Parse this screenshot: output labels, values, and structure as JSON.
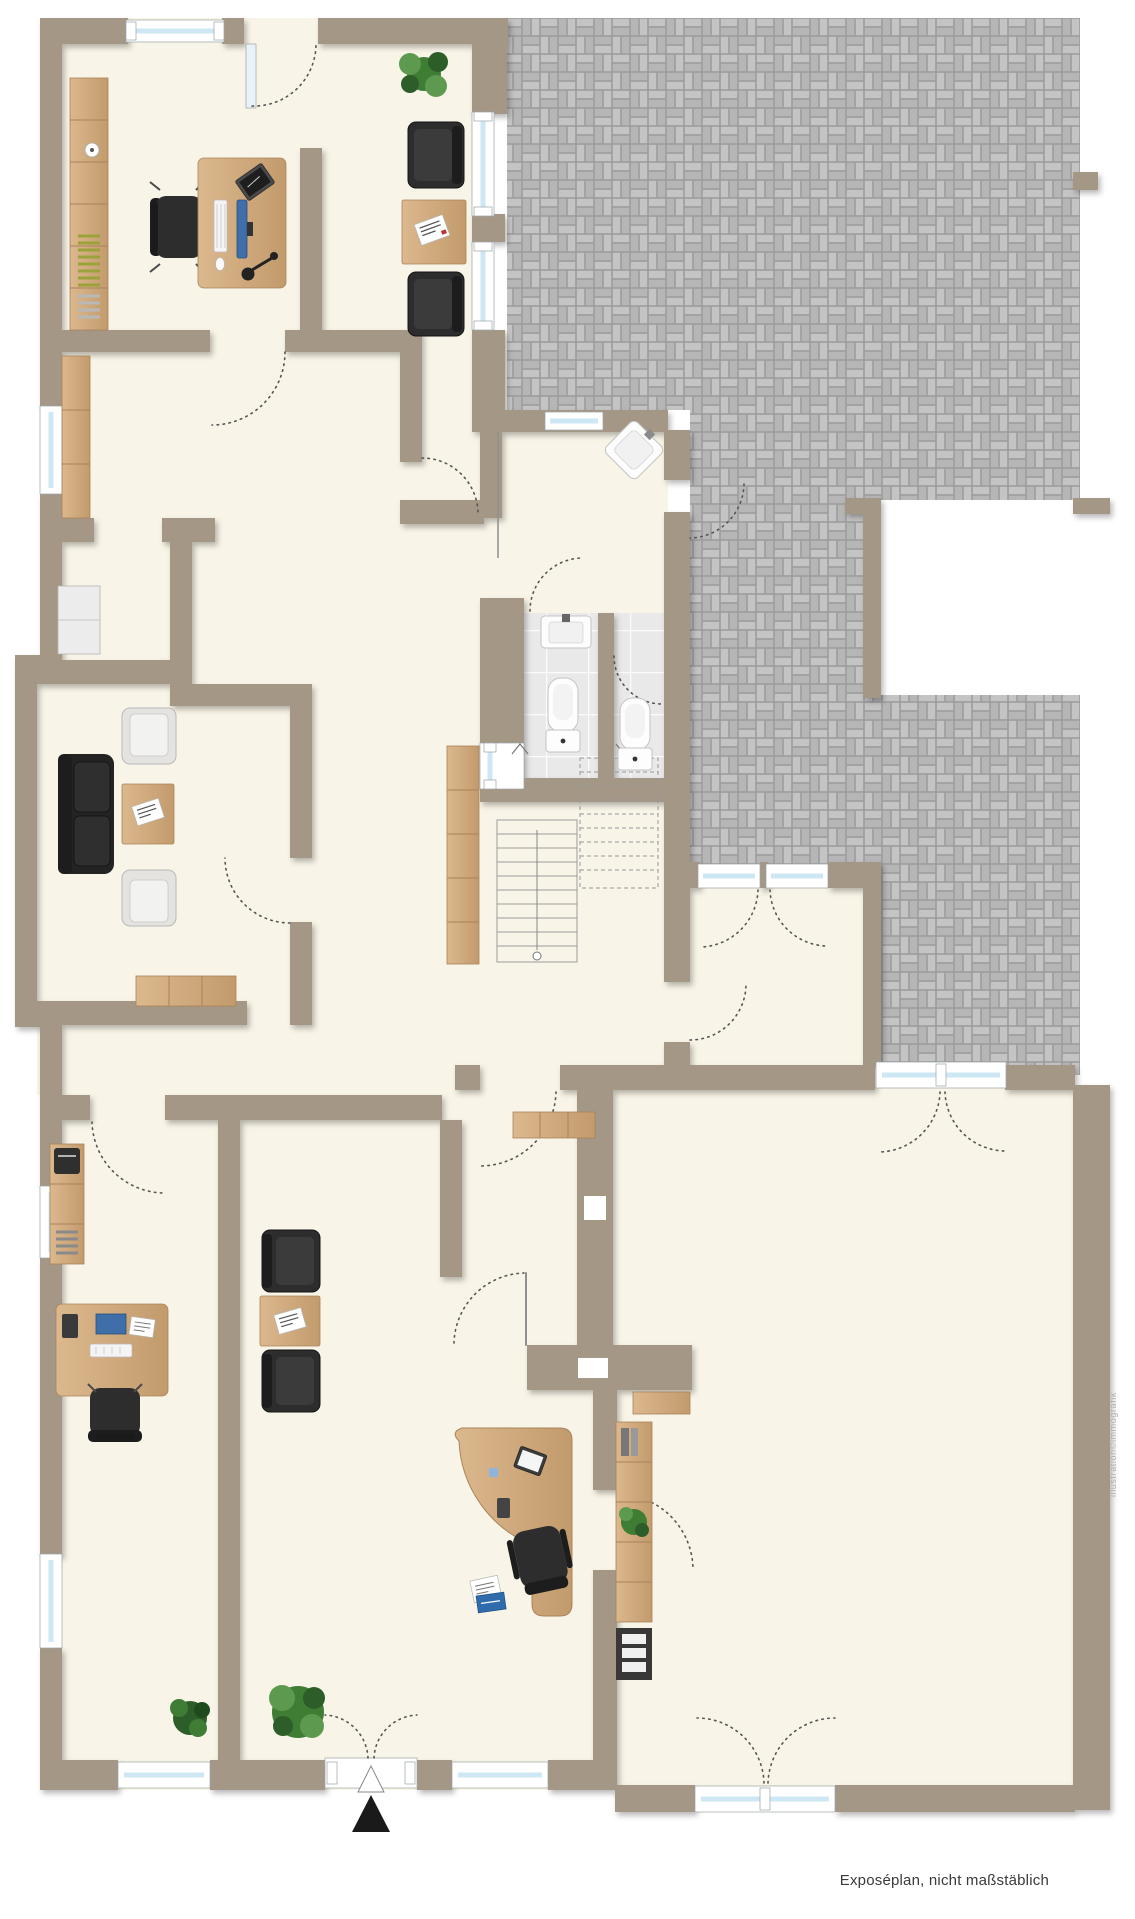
{
  "texts": {
    "caption": "Exposéplan, nicht maßstäblich",
    "watermark": "illustration©immografik"
  },
  "colors": {
    "wall": "#a49786",
    "floor": "#f8f4e7",
    "paver_joint": "#9d9d9d",
    "paver_a": "#c4c4c4",
    "paver_b": "#b6b6b6",
    "tile": "#e9e9e9",
    "tile_line": "#fbfbfb",
    "glass": "#cde8f4",
    "frame_stroke": "#9aa4a8",
    "wood_light": "#dcb88e",
    "wood_dark": "#c29b6c",
    "wood_line": "#a9835a",
    "black": "#2d2d2d",
    "black_dark": "#1d1d1d",
    "sofa": "#232323",
    "chair_light": "#e4e3e0",
    "plant": "#3f7d35",
    "plant_light": "#5d9a50",
    "plant_dark": "#2d5d28",
    "olive": "#9aa33a",
    "screen_blue": "#3f6ea9",
    "folder_blue": "#2e6cab",
    "fixture_white": "#fdfdfd",
    "arc": "#555555",
    "stair": "#9b9b9b",
    "caption": "#3a3a3a",
    "watermark": "#b3aea6"
  },
  "legend": {
    "rooms": [
      "office-top-left",
      "lounge-top",
      "paved-courtyard",
      "entrance-hall",
      "wc-left",
      "bathroom-right",
      "staircase-hall",
      "living-room",
      "corridor",
      "office-bottom-left",
      "office-bottom-center",
      "storage-room",
      "hall-bottom-right"
    ],
    "furniture": [
      "bookshelf",
      "desk",
      "office-chair",
      "monitor",
      "keyboard",
      "tablet",
      "desk-lamp",
      "armchair-black",
      "armchair-light",
      "side-table",
      "magazine",
      "sofa",
      "coffee-table",
      "sideboard",
      "wardrobe",
      "corner-sink",
      "washbasin",
      "toilet",
      "staircase",
      "reception-desk",
      "laptop",
      "plant",
      "shelf-black",
      "entrance-marker"
    ]
  }
}
